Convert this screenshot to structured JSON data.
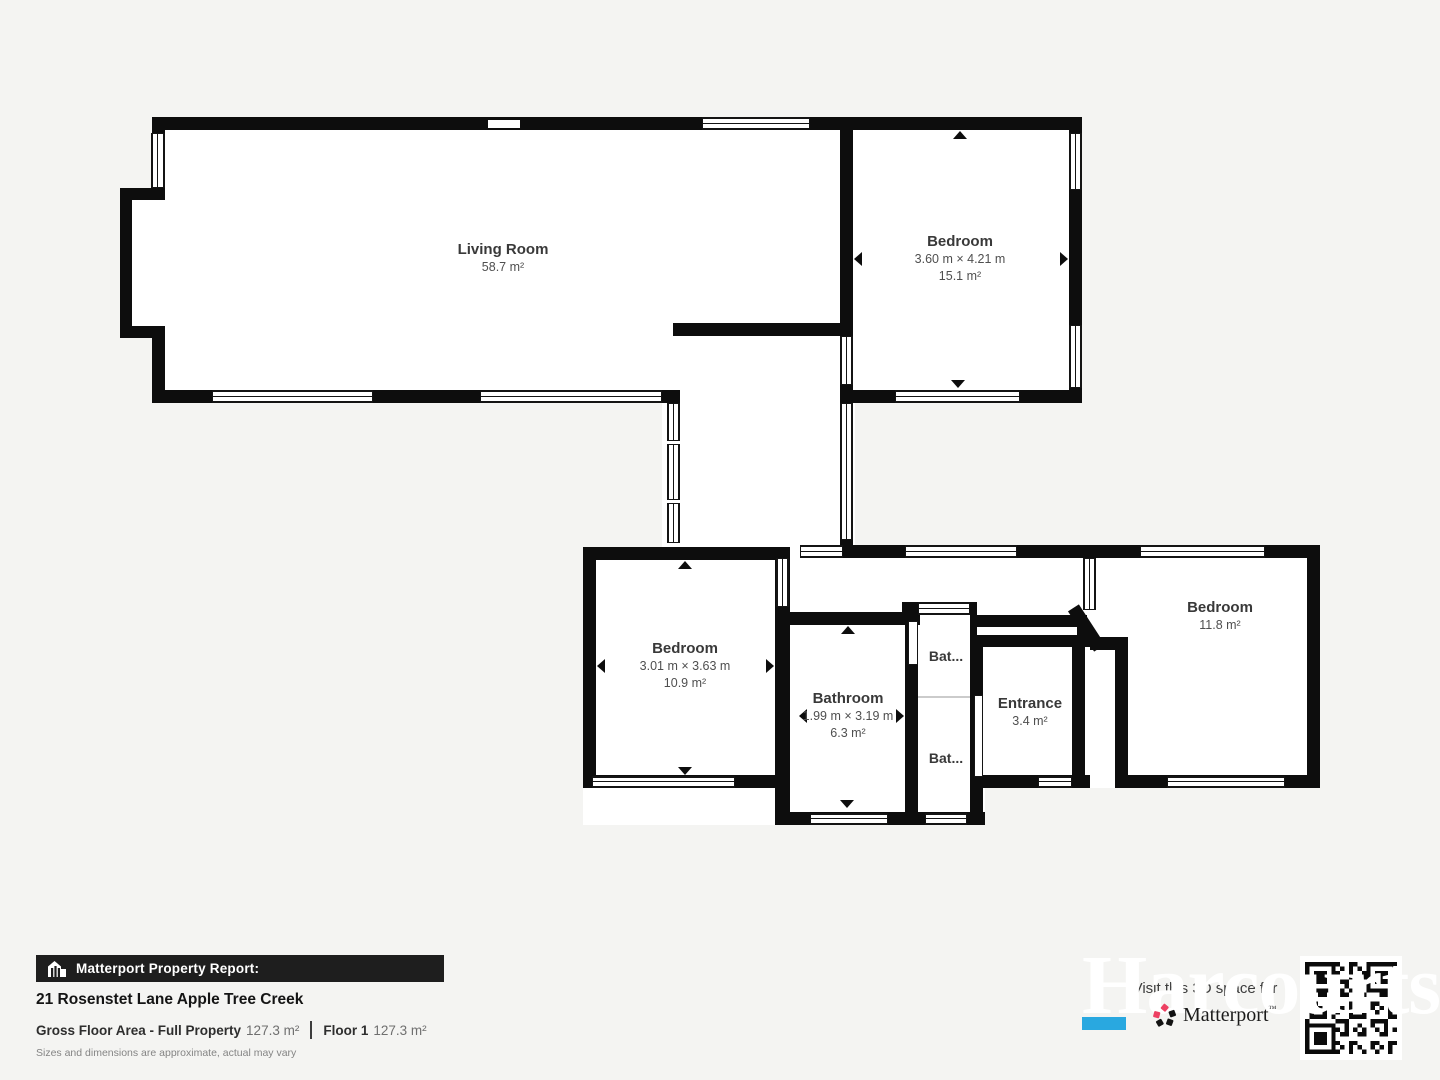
{
  "plan": {
    "rooms": {
      "living_room": {
        "name": "Living Room",
        "area": "58.7 m²"
      },
      "bedroom_top_right": {
        "name": "Bedroom",
        "dimensions": "3.60 m × 4.21 m",
        "area": "15.1 m²"
      },
      "bedroom_middle": {
        "name": "Bedroom",
        "dimensions": "3.01 m × 3.63 m",
        "area": "10.9 m²"
      },
      "bathroom": {
        "name": "Bathroom",
        "dimensions": "1.99 m × 3.19 m",
        "area": "6.3 m²"
      },
      "bathroom_small_top": {
        "name": "Bat..."
      },
      "bathroom_small_bottom": {
        "name": "Bat..."
      },
      "entrance": {
        "name": "Entrance",
        "area": "3.4 m²"
      },
      "bedroom_right": {
        "name": "Bedroom",
        "area": "11.8 m²"
      }
    }
  },
  "footer": {
    "banner_title": "Matterport Property Report:",
    "address": "21 Rosenstet Lane Apple Tree Creek",
    "gross_floor_area_label": "Gross Floor Area - Full Property",
    "gross_floor_area_value": "127.3 m²",
    "floor_label": "Floor 1",
    "floor_value": "127.3 m²",
    "disclaimer": "Sizes and dimensions are approximate, actual may vary"
  },
  "branding": {
    "watermark": "Harcourts",
    "tagline": "Visit this 3D space for",
    "matterport_wordmark": "Matterport",
    "trademark": "™",
    "accent_blue": "#29a8e0",
    "matterport_red": "#ed4062"
  }
}
